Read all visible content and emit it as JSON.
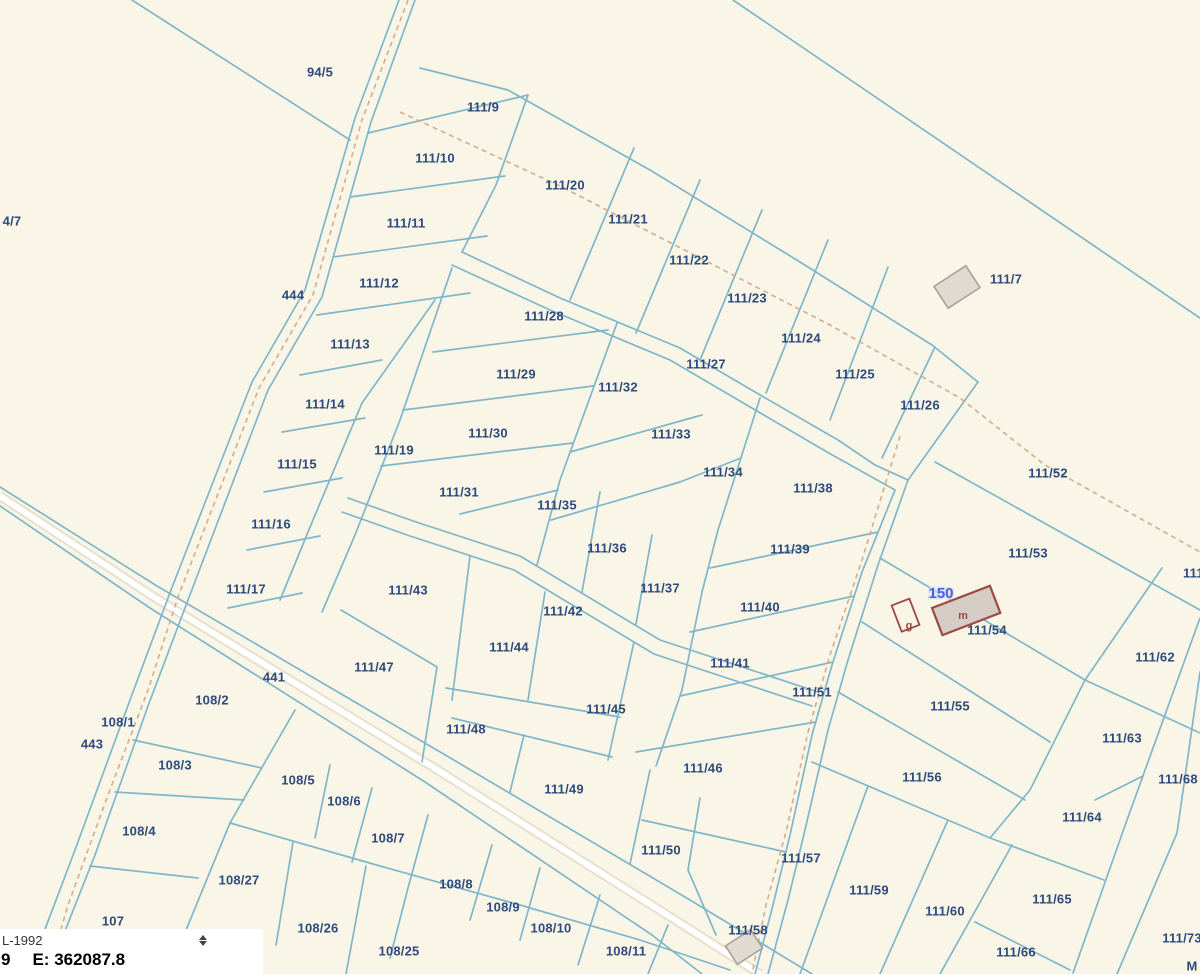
{
  "map": {
    "colors": {
      "background": "#faf6e7",
      "parcel_line": "#7fb6ca",
      "dashed_boundary": "#d4ac8b",
      "parcel_label": "#2d4a7d",
      "road_fill": "#ffffff",
      "road_shoulder": "#e8e0cd",
      "building_fill": "#e0dad2",
      "building_stroke": "#a8a198",
      "tagged_building_fill": "#d6ccc6",
      "tagged_building_stroke": "#9c4a41",
      "address_label": "#4d5fd6"
    },
    "parcel_labels": [
      {
        "t": "94/5",
        "x": 320,
        "y": 72
      },
      {
        "t": "111/9",
        "x": 483,
        "y": 107
      },
      {
        "t": "111/10",
        "x": 435,
        "y": 158
      },
      {
        "t": "4/7",
        "x": 12,
        "y": 221
      },
      {
        "t": "111/20",
        "x": 565,
        "y": 185
      },
      {
        "t": "111/21",
        "x": 628,
        "y": 219
      },
      {
        "t": "111/11",
        "x": 406,
        "y": 223
      },
      {
        "t": "111/22",
        "x": 689,
        "y": 260
      },
      {
        "t": "444",
        "x": 293,
        "y": 295
      },
      {
        "t": "111/12",
        "x": 379,
        "y": 283
      },
      {
        "t": "111/23",
        "x": 747,
        "y": 298
      },
      {
        "t": "111/7",
        "x": 1006,
        "y": 279
      },
      {
        "t": "111/28",
        "x": 544,
        "y": 316
      },
      {
        "t": "111/13",
        "x": 350,
        "y": 344
      },
      {
        "t": "111/24",
        "x": 801,
        "y": 338
      },
      {
        "t": "111/27",
        "x": 706,
        "y": 364
      },
      {
        "t": "111/29",
        "x": 516,
        "y": 374
      },
      {
        "t": "111/32",
        "x": 618,
        "y": 387
      },
      {
        "t": "111/25",
        "x": 855,
        "y": 374
      },
      {
        "t": "111/14",
        "x": 325,
        "y": 404
      },
      {
        "t": "111/26",
        "x": 920,
        "y": 405
      },
      {
        "t": "111/30",
        "x": 488,
        "y": 433
      },
      {
        "t": "111/33",
        "x": 671,
        "y": 434
      },
      {
        "t": "111/19",
        "x": 394,
        "y": 450
      },
      {
        "t": "111/15",
        "x": 297,
        "y": 464
      },
      {
        "t": "111/34",
        "x": 723,
        "y": 472
      },
      {
        "t": "111/38",
        "x": 813,
        "y": 488
      },
      {
        "t": "111/52",
        "x": 1048,
        "y": 473
      },
      {
        "t": "111/31",
        "x": 459,
        "y": 492
      },
      {
        "t": "111/35",
        "x": 557,
        "y": 505
      },
      {
        "t": "111/16",
        "x": 271,
        "y": 524
      },
      {
        "t": "111/36",
        "x": 607,
        "y": 548
      },
      {
        "t": "111/39",
        "x": 790,
        "y": 549
      },
      {
        "t": "111/53",
        "x": 1028,
        "y": 553
      },
      {
        "t": "111/17",
        "x": 246,
        "y": 589
      },
      {
        "t": "111/37",
        "x": 660,
        "y": 588
      },
      {
        "t": "111/43",
        "x": 408,
        "y": 590
      },
      {
        "t": "111/42",
        "x": 563,
        "y": 611
      },
      {
        "t": "111/40",
        "x": 760,
        "y": 607
      },
      {
        "t": "111/54",
        "x": 987,
        "y": 630
      },
      {
        "t": "111/6",
        "x": 1199,
        "y": 573
      },
      {
        "t": "111/62",
        "x": 1155,
        "y": 657
      },
      {
        "t": "111/44",
        "x": 509,
        "y": 647
      },
      {
        "t": "111/41",
        "x": 730,
        "y": 663
      },
      {
        "t": "111/47",
        "x": 374,
        "y": 667
      },
      {
        "t": "441",
        "x": 274,
        "y": 677
      },
      {
        "t": "108/2",
        "x": 212,
        "y": 700
      },
      {
        "t": "111/51",
        "x": 812,
        "y": 692
      },
      {
        "t": "111/55",
        "x": 950,
        "y": 706
      },
      {
        "t": "108/1",
        "x": 118,
        "y": 722
      },
      {
        "t": "111/45",
        "x": 606,
        "y": 709
      },
      {
        "t": "443",
        "x": 92,
        "y": 744
      },
      {
        "t": "111/63",
        "x": 1122,
        "y": 738
      },
      {
        "t": "111/48",
        "x": 466,
        "y": 729
      },
      {
        "t": "108/3",
        "x": 175,
        "y": 765
      },
      {
        "t": "108/5",
        "x": 298,
        "y": 780
      },
      {
        "t": "111/46",
        "x": 703,
        "y": 768
      },
      {
        "t": "111/56",
        "x": 922,
        "y": 777
      },
      {
        "t": "111/68",
        "x": 1178,
        "y": 779
      },
      {
        "t": "108/6",
        "x": 344,
        "y": 801
      },
      {
        "t": "108/4",
        "x": 139,
        "y": 831
      },
      {
        "t": "111/49",
        "x": 564,
        "y": 789
      },
      {
        "t": "111/64",
        "x": 1082,
        "y": 817
      },
      {
        "t": "108/7",
        "x": 388,
        "y": 838
      },
      {
        "t": "111/50",
        "x": 661,
        "y": 850
      },
      {
        "t": "111/57",
        "x": 801,
        "y": 858
      },
      {
        "t": "108/8",
        "x": 456,
        "y": 884
      },
      {
        "t": "111/59",
        "x": 869,
        "y": 890
      },
      {
        "t": "108/27",
        "x": 239,
        "y": 880
      },
      {
        "t": "111/60",
        "x": 945,
        "y": 911
      },
      {
        "t": "111/65",
        "x": 1052,
        "y": 899
      },
      {
        "t": "107",
        "x": 113,
        "y": 921
      },
      {
        "t": "108/26",
        "x": 318,
        "y": 928
      },
      {
        "t": "108/9",
        "x": 503,
        "y": 907
      },
      {
        "t": "111/66",
        "x": 1016,
        "y": 952
      },
      {
        "t": "108/10",
        "x": 551,
        "y": 928
      },
      {
        "t": "108/25",
        "x": 399,
        "y": 951
      },
      {
        "t": "111/58",
        "x": 748,
        "y": 930
      },
      {
        "t": "108/11",
        "x": 626,
        "y": 951
      },
      {
        "t": "111/73",
        "x": 1182,
        "y": 938
      },
      {
        "t": "M",
        "x": 1192,
        "y": 966
      }
    ],
    "address_labels": [
      {
        "t": "150",
        "x": 941,
        "y": 593
      }
    ],
    "building_letters": [
      {
        "t": "m",
        "x": 963,
        "y": 615
      },
      {
        "t": "g",
        "x": 909,
        "y": 625
      }
    ]
  },
  "statusbar": {
    "system": "L-1992",
    "northing_fragment": "9",
    "easting": "E: 362087.8"
  }
}
